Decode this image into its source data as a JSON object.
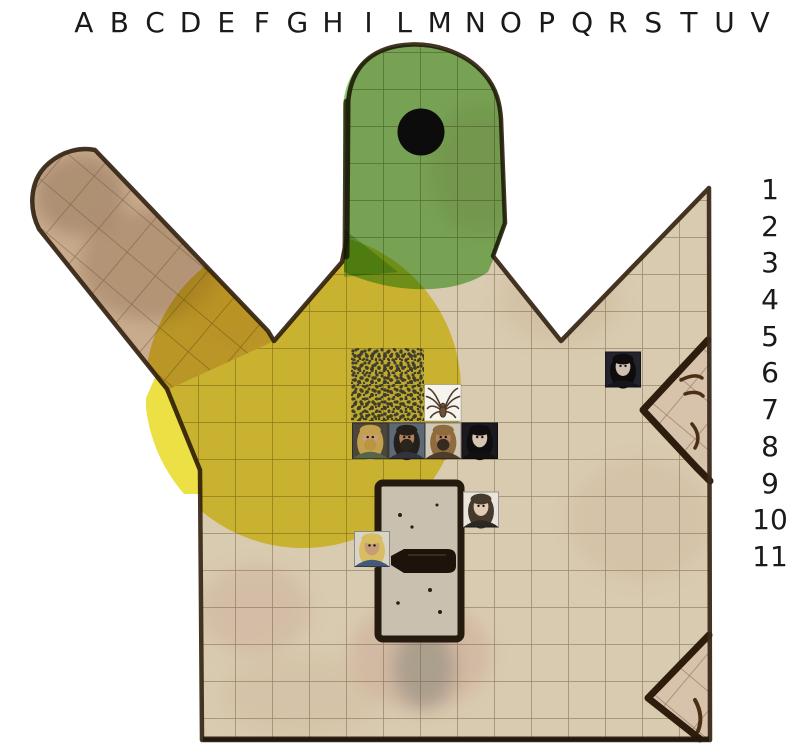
{
  "page": {
    "width": 801,
    "height": 750,
    "background": "#ffffff"
  },
  "board": {
    "column_labels": [
      "A",
      "B",
      "C",
      "D",
      "E",
      "F",
      "G",
      "H",
      "I",
      "L",
      "M",
      "N",
      "O",
      "P",
      "Q",
      "R",
      "S",
      "T",
      "U",
      "V"
    ],
    "row_labels": [
      "1",
      "2",
      "3",
      "4",
      "5",
      "6",
      "7",
      "8",
      "9",
      "10",
      "11"
    ],
    "label_color": "#1a1a1a"
  },
  "map": {
    "floor_color": "#d9cbb0",
    "arm_floor_color": "#c9ab8e",
    "grid_color": "rgba(104,80,50,0.55)",
    "wall_color": "#3a2918",
    "bottom_edge_color": "#20160c",
    "structure_wall_color": "#2e1d0c",
    "structure_floor_color": "#d7c2ab",
    "structure_mark_color": "#4a2f15",
    "door": {
      "fill": "#c9c0b0",
      "border": "#241a0d",
      "handle": "#1c130a",
      "speck": "#2b1e10",
      "shadow": "#55645c"
    },
    "highlights": {
      "yellow_zone": {
        "shape": "circle",
        "cx": 303,
        "cy": 390,
        "r": 158,
        "color": "#e8d816",
        "opacity": 0.8
      },
      "green_zone": {
        "color": "#7cc465",
        "opacity": 0.88
      },
      "green_spill": {
        "opacity": 0.55
      },
      "pit": {
        "cx": 421,
        "cy": 132,
        "r": 23.5,
        "color": "#0c0c0c"
      }
    }
  },
  "tokens": [
    {
      "name": "spider-swarm-token",
      "kind": "swarm",
      "x": 351,
      "y": 348,
      "size": 73,
      "colors": {
        "dot": "#3f3d2c",
        "tint": "rgba(70,70,40,0.07)"
      }
    },
    {
      "name": "spider-token",
      "kind": "spider",
      "x": 424.5,
      "y": 384.5,
      "size": 36.5,
      "colors": {
        "bg": "#f6f4ee",
        "leg": "#4f3d2a",
        "body": "#6a5138"
      }
    },
    {
      "name": "portrait-blond-bearded-man",
      "kind": "portrait",
      "x": 352,
      "y": 422.5,
      "size": 36.5,
      "colors": {
        "bg": "#4c463a",
        "hair": "#c3a04e",
        "skin": "#c79f78",
        "beard": "#b99441",
        "clothes": "#56644a"
      }
    },
    {
      "name": "portrait-dark-haired-man",
      "kind": "portrait",
      "x": 388.5,
      "y": 422.5,
      "size": 36.5,
      "colors": {
        "bg": "#5d6a76",
        "hair": "#241f1a",
        "skin": "#b08059",
        "beard": "#2a241e",
        "clothes": "#31343c"
      }
    },
    {
      "name": "portrait-helmed-dwarf",
      "kind": "portrait",
      "x": 425,
      "y": 422.5,
      "size": 36.5,
      "colors": {
        "bg": "#cfc8b9",
        "hair": "#8e6c3e",
        "skin": "#b3835c",
        "beard": "#352a20",
        "clothes": "#4f3d2c"
      }
    },
    {
      "name": "portrait-pale-woman",
      "kind": "portrait",
      "x": 461.5,
      "y": 422.5,
      "size": 36.5,
      "colors": {
        "bg": "#1a1a20",
        "hair": "#0f0d0d",
        "skin": "#d6c4b2",
        "clothes": "#111114"
      }
    },
    {
      "name": "portrait-pale-woman-right",
      "kind": "portrait",
      "x": 605,
      "y": 351.5,
      "size": 36,
      "colors": {
        "bg": "#23232e",
        "hair": "#0e0c0c",
        "skin": "#cfc0b2",
        "clothes": "#15151c"
      }
    },
    {
      "name": "portrait-elf-woman",
      "kind": "portrait",
      "x": 463,
      "y": 491.5,
      "size": 36,
      "colors": {
        "bg": "#e9e5dc",
        "hair": "#463a2c",
        "skin": "#e2cbb4",
        "clothes": "#2c2824"
      }
    },
    {
      "name": "portrait-blond-warrior",
      "kind": "portrait",
      "x": 354,
      "y": 531,
      "size": 36,
      "colors": {
        "bg": "#d9d5c6",
        "hair": "#d9bd62",
        "skin": "#c79d76",
        "clothes": "#44597a"
      }
    }
  ]
}
